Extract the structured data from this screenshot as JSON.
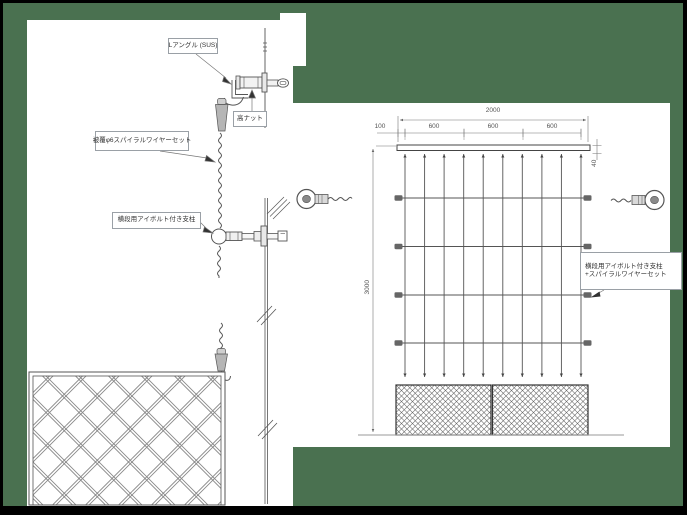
{
  "colors": {
    "frame": "#000000",
    "desktop": "#4a7150",
    "page": "#ffffff",
    "linework": "#555555"
  },
  "left_view": {
    "label_l_angle": "Lアングル (SUS)",
    "label_high_nut": "高ナット",
    "label_wire_set": "被覆φ6スパイラルワイヤーセット",
    "label_post": "横段用アイボルト付き支柱"
  },
  "elevation": {
    "dim_total_width": "2000",
    "dim_left_offset": "100",
    "dim_spacing": [
      "600",
      "600",
      "600"
    ],
    "dim_bar_height": "40",
    "dim_total_height": "3000",
    "label_line1": "横段用アイボルト付き支柱",
    "label_line2": "+スパイラルワイヤーセット"
  }
}
